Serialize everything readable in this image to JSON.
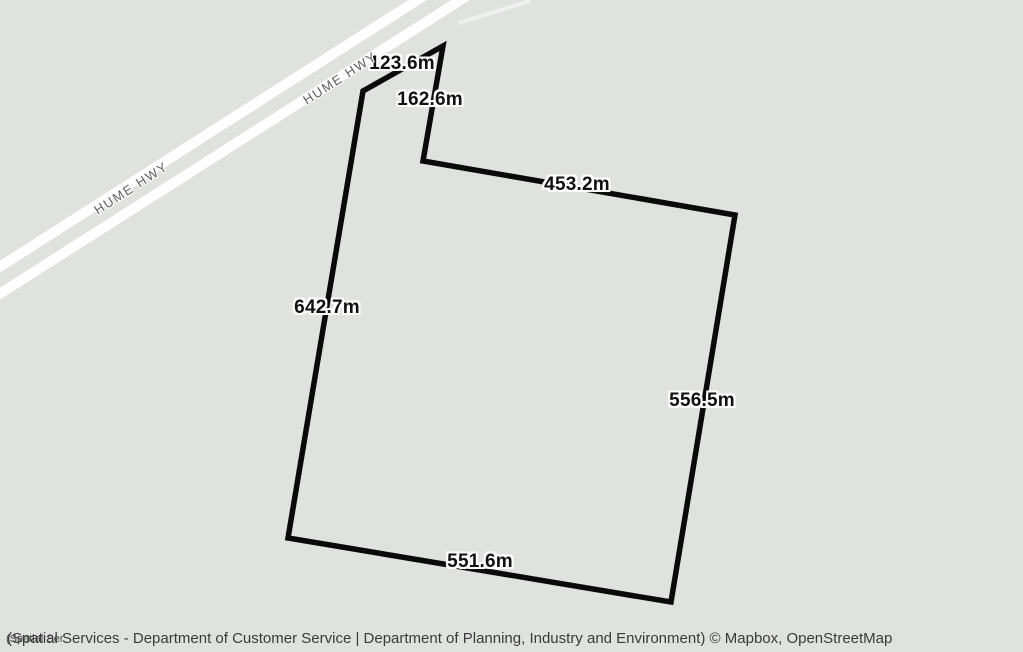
{
  "map": {
    "background_color": "#e0e2e0",
    "road_color": "#ffffff",
    "road_labels": [
      {
        "text": "HUME HWY"
      },
      {
        "text": "HUME HWY"
      }
    ],
    "parcel": {
      "outline_color": "#0a0a0a",
      "side_labels": [
        {
          "text": "123.6m"
        },
        {
          "text": "162.6m"
        },
        {
          "text": "453.2m"
        },
        {
          "text": "642.7m"
        },
        {
          "text": "556.5m"
        },
        {
          "text": "551.6m"
        }
      ]
    }
  },
  "attribution": {
    "main": "(Spatial Services - Department of Customer Service | Department of Planning, Industry and Environment) © Mapbox, OpenStreetMap",
    "overlapping_fragment": "(Spatial Ser"
  }
}
